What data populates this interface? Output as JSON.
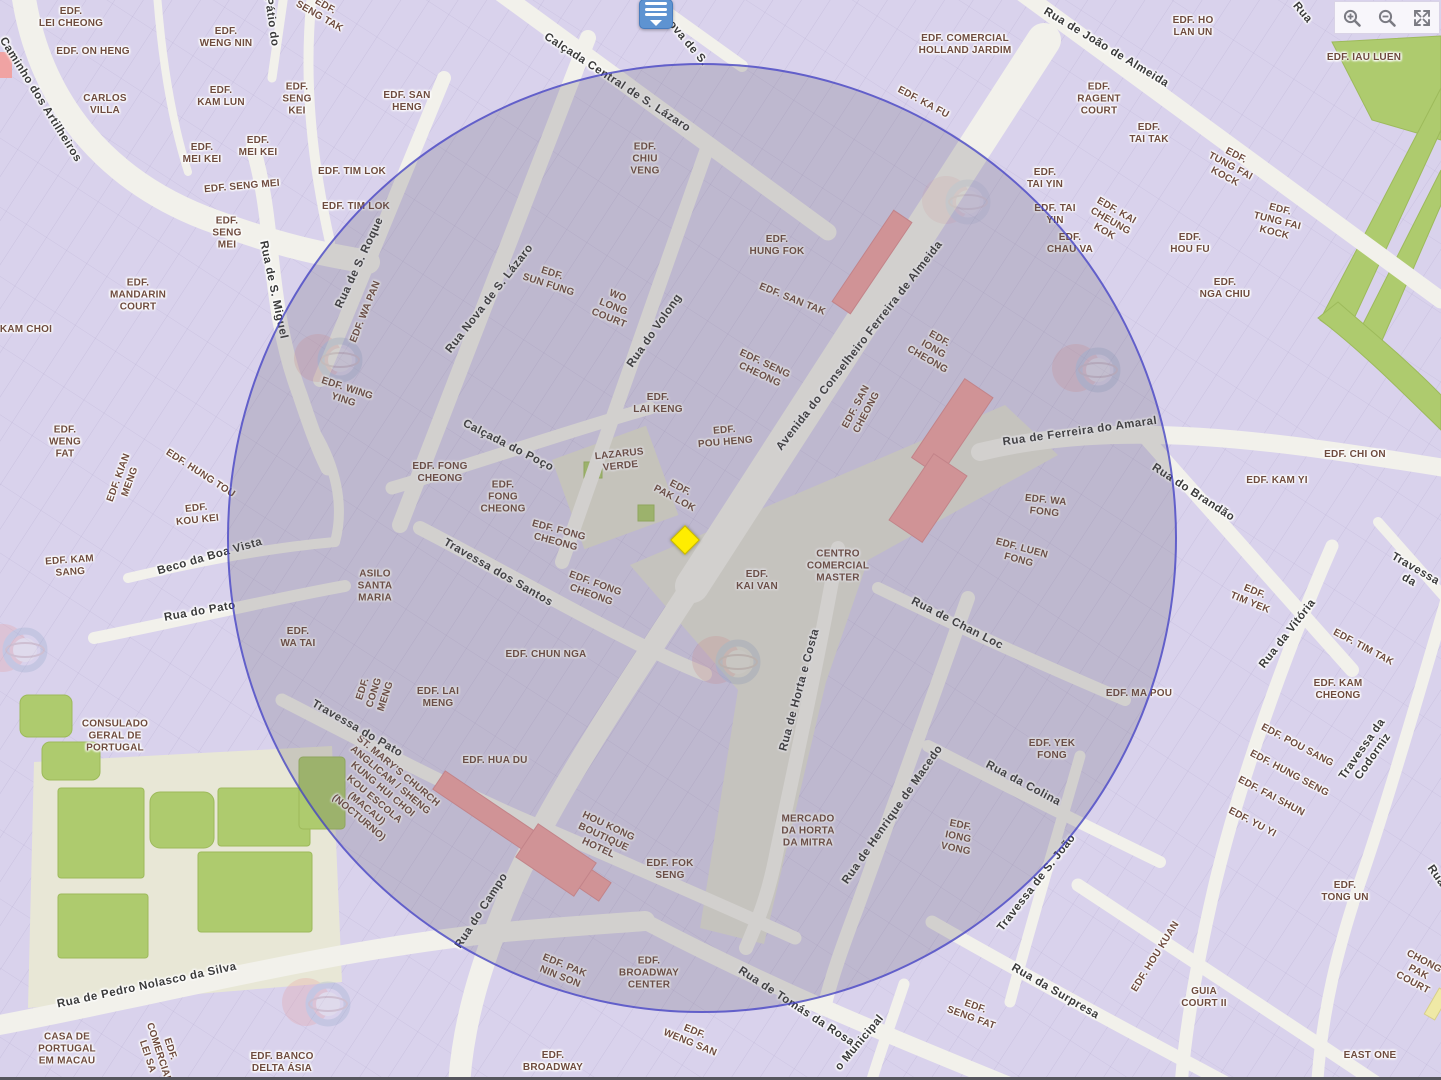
{
  "map": {
    "palette": {
      "building_fill": "#D9D2EC",
      "street_fill": "#F2F1EB",
      "green": "#AECB6E",
      "courtyard": "#E8E7D6",
      "highlight_red": "#F0A3A3",
      "highlight_yellow_building": "#EFE9A6",
      "circle_stroke": "#4342C8",
      "building_label": "#6E4B3E",
      "street_label": "#3A3A3A",
      "marker_yellow": "#FFED00",
      "marker_blue": "#5E93D1"
    },
    "controls": [
      {
        "id": "zoom-in"
      },
      {
        "id": "zoom-out"
      },
      {
        "id": "fullscreen"
      }
    ],
    "selection_circle": {
      "cx": 702,
      "cy": 538,
      "r": 475
    },
    "markers": {
      "selected_location": {
        "x": 685,
        "y": 540
      },
      "list_pin": {
        "x": 656,
        "y": 14
      }
    },
    "labels": [
      {
        "t": "EDF.\nLEI CHEONG",
        "x": 71,
        "y": 18,
        "r": 0,
        "k": "b"
      },
      {
        "t": "EDF. ON HENG",
        "x": 93,
        "y": 52,
        "r": 0,
        "k": "b"
      },
      {
        "t": "CARLOS\nVILLA",
        "x": 105,
        "y": 105,
        "r": 0,
        "k": "b"
      },
      {
        "t": "EDF.\nWENG NIN",
        "x": 226,
        "y": 38,
        "r": 0,
        "k": "b"
      },
      {
        "t": "EDF.\nKAM LUN",
        "x": 221,
        "y": 97,
        "r": 0,
        "k": "b"
      },
      {
        "t": "EDF.\nSENG\nKEI",
        "x": 297,
        "y": 100,
        "r": 0,
        "k": "b"
      },
      {
        "t": "EDF.\nMEI KEI",
        "x": 202,
        "y": 154,
        "r": 0,
        "k": "b"
      },
      {
        "t": "EDF.\nMEI KEI",
        "x": 258,
        "y": 147,
        "r": 0,
        "k": "b"
      },
      {
        "t": "EDF. SENG MEI",
        "x": 242,
        "y": 187,
        "r": -5,
        "k": "b"
      },
      {
        "t": "EDF.\nSENG\nMEI",
        "x": 227,
        "y": 234,
        "r": 0,
        "k": "b"
      },
      {
        "t": "EDF.\nSENG TAK",
        "x": 322,
        "y": 12,
        "r": 30,
        "k": "b"
      },
      {
        "t": "EDF. TIM LOK",
        "x": 352,
        "y": 172,
        "r": 0,
        "k": "b"
      },
      {
        "t": "EDF. TIM LOK",
        "x": 356,
        "y": 207,
        "r": 0,
        "k": "b"
      },
      {
        "t": "EDF. SAN\nHENG",
        "x": 407,
        "y": 102,
        "r": 0,
        "k": "b"
      },
      {
        "t": "EDF.\nMANDARIN\nCOURT",
        "x": 138,
        "y": 296,
        "r": 0,
        "k": "b"
      },
      {
        "t": "KAM CHOI",
        "x": 26,
        "y": 330,
        "r": 0,
        "k": "b"
      },
      {
        "t": "EDF.\nWENG\nFAT",
        "x": 65,
        "y": 443,
        "r": 0,
        "k": "b"
      },
      {
        "t": "EDF. KIAN\nMENG",
        "x": 125,
        "y": 480,
        "r": -70,
        "k": "b"
      },
      {
        "t": "EDF. HUNG TOU",
        "x": 200,
        "y": 474,
        "r": 33,
        "k": "b"
      },
      {
        "t": "EDF.\nKOU KEI",
        "x": 197,
        "y": 515,
        "r": -6,
        "k": "b"
      },
      {
        "t": "EDF. KAM\nSANG",
        "x": 70,
        "y": 567,
        "r": -4,
        "k": "b"
      },
      {
        "t": "EDF. WING\nYING",
        "x": 345,
        "y": 395,
        "r": 18,
        "k": "b"
      },
      {
        "t": "EDF. WA PAN",
        "x": 366,
        "y": 312,
        "r": -68,
        "k": "b"
      },
      {
        "t": "EDF.\nSUN FUNG",
        "x": 550,
        "y": 280,
        "r": 18,
        "k": "b"
      },
      {
        "t": "WO\nLONG\nCOURT",
        "x": 613,
        "y": 308,
        "r": 22,
        "k": "b"
      },
      {
        "t": "EDF.\nCHIU\nVENG",
        "x": 645,
        "y": 160,
        "r": 0,
        "k": "b"
      },
      {
        "t": "EDF.\nHUNG FOK",
        "x": 777,
        "y": 246,
        "r": 0,
        "k": "b"
      },
      {
        "t": "EDF. SAN TAK",
        "x": 792,
        "y": 300,
        "r": 22,
        "k": "b"
      },
      {
        "t": "EDF. SENG\nCHEONG",
        "x": 762,
        "y": 370,
        "r": 25,
        "k": "b"
      },
      {
        "t": "EDF.\nLAI KENG",
        "x": 658,
        "y": 404,
        "r": 0,
        "k": "b"
      },
      {
        "t": "EDF.\nPOU HENG",
        "x": 725,
        "y": 437,
        "r": -5,
        "k": "b"
      },
      {
        "t": "LAZARUS\nVERDE",
        "x": 620,
        "y": 461,
        "r": -6,
        "k": "b"
      },
      {
        "t": "EDF.\nPAK LOK",
        "x": 677,
        "y": 494,
        "r": 28,
        "k": "b"
      },
      {
        "t": "EDF. FONG\nCHEONG",
        "x": 440,
        "y": 473,
        "r": 0,
        "k": "b"
      },
      {
        "t": "EDF.\nFONG\nCHEONG",
        "x": 503,
        "y": 498,
        "r": 0,
        "k": "b"
      },
      {
        "t": "EDF. FONG\nCHEONG",
        "x": 557,
        "y": 537,
        "r": 15,
        "k": "b"
      },
      {
        "t": "EDF. FONG\nCHEONG",
        "x": 593,
        "y": 590,
        "r": 20,
        "k": "b"
      },
      {
        "t": "EDF.\nIONG\nCHEONG",
        "x": 933,
        "y": 350,
        "r": 30,
        "k": "b"
      },
      {
        "t": "EDF. SAN\nCHEONG",
        "x": 862,
        "y": 410,
        "r": -62,
        "k": "b"
      },
      {
        "t": "CENTRO\nCOMERCIAL\nMASTER",
        "x": 838,
        "y": 567,
        "r": 0,
        "k": "b"
      },
      {
        "t": "EDF.\nKAI VAN",
        "x": 757,
        "y": 581,
        "r": 0,
        "k": "b"
      },
      {
        "t": "EDF. WA\nFONG",
        "x": 1045,
        "y": 507,
        "r": 6,
        "k": "b"
      },
      {
        "t": "EDF. LUEN\nFONG",
        "x": 1020,
        "y": 555,
        "r": 15,
        "k": "b"
      },
      {
        "t": "ASILO\nSANTA\nMARIA",
        "x": 375,
        "y": 587,
        "r": 0,
        "k": "b"
      },
      {
        "t": "EDF.\nWA TAI",
        "x": 298,
        "y": 638,
        "r": 0,
        "k": "b"
      },
      {
        "t": "EDF.\nCONG\nMENG",
        "x": 375,
        "y": 693,
        "r": -72,
        "k": "b"
      },
      {
        "t": "EDF. LAI\nMENG",
        "x": 438,
        "y": 698,
        "r": 0,
        "k": "b"
      },
      {
        "t": "EDF. CHUN NGA",
        "x": 546,
        "y": 655,
        "r": 0,
        "k": "b"
      },
      {
        "t": "EDF. HUA DU",
        "x": 495,
        "y": 761,
        "r": 0,
        "k": "b"
      },
      {
        "t": "ST. MARY'S CHURCH\nANGLICAM / SHENG\nKUNG HUI CHOI\nKOU ESCOLA\n(MACAU)\n(NOCTURNO)",
        "x": 378,
        "y": 795,
        "r": 40,
        "k": "b"
      },
      {
        "t": "HOU KONG\nBOUTIQUE\nHOTEL",
        "x": 603,
        "y": 838,
        "r": 25,
        "k": "b"
      },
      {
        "t": "EDF. FOK\nSENG",
        "x": 670,
        "y": 870,
        "r": 0,
        "k": "b"
      },
      {
        "t": "EDF. PAK\nNIN SON",
        "x": 562,
        "y": 972,
        "r": 22,
        "k": "b"
      },
      {
        "t": "EDF.\nBROADWAY\nCENTER",
        "x": 649,
        "y": 974,
        "r": 0,
        "k": "b"
      },
      {
        "t": "EDF.\nWENG SAN",
        "x": 692,
        "y": 1038,
        "r": 22,
        "k": "b"
      },
      {
        "t": "EDF.\nBROADWAY",
        "x": 553,
        "y": 1062,
        "r": 0,
        "k": "b"
      },
      {
        "t": "MERCADO\nDA HORTA\nDA MITRA",
        "x": 808,
        "y": 832,
        "r": 0,
        "k": "b"
      },
      {
        "t": "EDF.\nIONG\nVONG",
        "x": 958,
        "y": 838,
        "r": 12,
        "k": "b"
      },
      {
        "t": "EDF.\nSENG FAT",
        "x": 973,
        "y": 1013,
        "r": 20,
        "k": "b"
      },
      {
        "t": "EDF. YEK\nFONG",
        "x": 1052,
        "y": 750,
        "r": 0,
        "k": "b"
      },
      {
        "t": "EDF. MA POU",
        "x": 1139,
        "y": 694,
        "r": 0,
        "k": "b"
      },
      {
        "t": "EDF. COMERCIAL\nHOLLAND JARDIM",
        "x": 965,
        "y": 45,
        "r": 0,
        "k": "b"
      },
      {
        "t": "EDF. KA FU",
        "x": 923,
        "y": 103,
        "r": 28,
        "k": "b"
      },
      {
        "t": "EDF.\nRAGENT\nCOURT",
        "x": 1099,
        "y": 100,
        "r": 0,
        "k": "b"
      },
      {
        "t": "EDF.\nTAI TAK",
        "x": 1149,
        "y": 134,
        "r": 0,
        "k": "b"
      },
      {
        "t": "EDF.\nTAI YIN",
        "x": 1045,
        "y": 179,
        "r": 0,
        "k": "b"
      },
      {
        "t": "EDF. TAI\nYIN",
        "x": 1055,
        "y": 215,
        "r": 0,
        "k": "b"
      },
      {
        "t": "EDF.\nCHAU VA",
        "x": 1070,
        "y": 244,
        "r": 0,
        "k": "b"
      },
      {
        "t": "EDF. KAI\nCHEUNG\nKOK",
        "x": 1110,
        "y": 222,
        "r": 30,
        "k": "b"
      },
      {
        "t": "EDF. HO\nLAN UN",
        "x": 1193,
        "y": 27,
        "r": 0,
        "k": "b"
      },
      {
        "t": "EDF. IAU LUEN",
        "x": 1364,
        "y": 58,
        "r": 0,
        "k": "b"
      },
      {
        "t": "EDF.\nTUNG FAI\nKOCK",
        "x": 1230,
        "y": 167,
        "r": 28,
        "k": "b"
      },
      {
        "t": "EDF.\nTUNG FAI\nKOCK",
        "x": 1277,
        "y": 222,
        "r": 14,
        "k": "b"
      },
      {
        "t": "EDF.\nHOU FU",
        "x": 1190,
        "y": 244,
        "r": 0,
        "k": "b"
      },
      {
        "t": "EDF.\nNGA CHIU",
        "x": 1225,
        "y": 289,
        "r": 0,
        "k": "b"
      },
      {
        "t": "EDF. CHI ON",
        "x": 1355,
        "y": 455,
        "r": 0,
        "k": "b"
      },
      {
        "t": "EDF. KAM YI",
        "x": 1277,
        "y": 481,
        "r": 0,
        "k": "b"
      },
      {
        "t": "EDF.\nTIM YEK",
        "x": 1252,
        "y": 598,
        "r": 22,
        "k": "b"
      },
      {
        "t": "EDF. TIM TAK",
        "x": 1363,
        "y": 648,
        "r": 28,
        "k": "b"
      },
      {
        "t": "EDF. KAM\nCHEONG",
        "x": 1338,
        "y": 690,
        "r": 0,
        "k": "b"
      },
      {
        "t": "EDF. POU SANG",
        "x": 1297,
        "y": 746,
        "r": 28,
        "k": "b"
      },
      {
        "t": "EDF. HUNG SENG",
        "x": 1289,
        "y": 774,
        "r": 28,
        "k": "b"
      },
      {
        "t": "EDF. FAI SHUN",
        "x": 1271,
        "y": 797,
        "r": 28,
        "k": "b"
      },
      {
        "t": "EDF. YU YI",
        "x": 1252,
        "y": 823,
        "r": 28,
        "k": "b"
      },
      {
        "t": "EDF.\nTONG UN",
        "x": 1345,
        "y": 892,
        "r": 0,
        "k": "b"
      },
      {
        "t": "EDF. HOU KUAN",
        "x": 1156,
        "y": 957,
        "r": -58,
        "k": "b"
      },
      {
        "t": "GUIA\nCOURT II",
        "x": 1204,
        "y": 998,
        "r": 0,
        "k": "b"
      },
      {
        "t": "EAST ONE",
        "x": 1370,
        "y": 1056,
        "r": 0,
        "k": "b"
      },
      {
        "t": "CHONG\nPAK\nCOURT",
        "x": 1418,
        "y": 973,
        "r": 28,
        "k": "b"
      },
      {
        "t": "CASA DE\nPORTUGAL\nEM MACAU",
        "x": 67,
        "y": 1050,
        "r": 0,
        "k": "b"
      },
      {
        "t": "EDF.\nCOMERCIAL\nLEI SA",
        "x": 158,
        "y": 1053,
        "r": 72,
        "k": "b"
      },
      {
        "t": "EDF. BANCO\nDELTA ÁSIA",
        "x": 282,
        "y": 1063,
        "r": 0,
        "k": "b"
      },
      {
        "t": "CONSULADO\nGERAL DE\nPORTUGAL",
        "x": 115,
        "y": 737,
        "r": 0,
        "k": "b"
      },
      {
        "t": "Caminho dos Artilheiros",
        "x": 40,
        "y": 100,
        "r": 58,
        "k": "s"
      },
      {
        "t": "Pátio do",
        "x": 271,
        "y": 22,
        "r": 82,
        "k": "s"
      },
      {
        "t": "Rua de S. Miguel",
        "x": 273,
        "y": 290,
        "r": 78,
        "k": "s"
      },
      {
        "t": "Rua de S. Roque",
        "x": 360,
        "y": 263,
        "r": -65,
        "k": "s"
      },
      {
        "t": "Rua Nova de S. Lázaro",
        "x": 490,
        "y": 299,
        "r": -52,
        "k": "s"
      },
      {
        "t": "Rua Nova de S.",
        "x": 676,
        "y": 30,
        "r": 50,
        "k": "s"
      },
      {
        "t": "Calçada Central de S. Lázaro",
        "x": 617,
        "y": 83,
        "r": 33,
        "k": "s"
      },
      {
        "t": "Rua do Volong",
        "x": 655,
        "y": 331,
        "r": -55,
        "k": "s"
      },
      {
        "t": "Avenida do Conselheiro Ferreira de Almeida",
        "x": 860,
        "y": 346,
        "r": -52,
        "k": "s"
      },
      {
        "t": "Rua de João de Almeida",
        "x": 1106,
        "y": 48,
        "r": 31,
        "k": "s"
      },
      {
        "t": "Rua de Ferreira do Amaral",
        "x": 1080,
        "y": 432,
        "r": -8,
        "k": "s"
      },
      {
        "t": "Rua do Brandão",
        "x": 1193,
        "y": 493,
        "r": 33,
        "k": "s"
      },
      {
        "t": "Travessa da",
        "x": 1412,
        "y": 575,
        "r": 30,
        "k": "s"
      },
      {
        "t": "Rua da Vitória",
        "x": 1288,
        "y": 634,
        "r": -52,
        "k": "s"
      },
      {
        "t": "Travessa da Codorniz",
        "x": 1368,
        "y": 753,
        "r": -55,
        "k": "s"
      },
      {
        "t": "Calçada do Poço",
        "x": 508,
        "y": 446,
        "r": 27,
        "k": "s"
      },
      {
        "t": "Travessa dos Santos",
        "x": 498,
        "y": 573,
        "r": 30,
        "k": "s"
      },
      {
        "t": "Beco da Boa Vista",
        "x": 210,
        "y": 557,
        "r": -16,
        "k": "s"
      },
      {
        "t": "Rua do Pato",
        "x": 200,
        "y": 612,
        "r": -10,
        "k": "s"
      },
      {
        "t": "Travessa do Pato",
        "x": 357,
        "y": 729,
        "r": 30,
        "k": "s"
      },
      {
        "t": "Rua do Campo",
        "x": 482,
        "y": 911,
        "r": -57,
        "k": "s"
      },
      {
        "t": "Rua de Horta e Costa",
        "x": 800,
        "y": 690,
        "r": -75,
        "k": "s"
      },
      {
        "t": "Rua de Henrique de Macedo",
        "x": 893,
        "y": 815,
        "r": -55,
        "k": "s"
      },
      {
        "t": "Rua de Chan Loc",
        "x": 957,
        "y": 624,
        "r": 27,
        "k": "s"
      },
      {
        "t": "Rua da Colina",
        "x": 1023,
        "y": 784,
        "r": 28,
        "k": "s"
      },
      {
        "t": "Travessa de S. João",
        "x": 1037,
        "y": 883,
        "r": -52,
        "k": "s"
      },
      {
        "t": "Rua da Surpresa",
        "x": 1055,
        "y": 992,
        "r": 30,
        "k": "s"
      },
      {
        "t": "Rua de Tomás da Rosa",
        "x": 796,
        "y": 1007,
        "r": 33,
        "k": "s"
      },
      {
        "t": "o Municipal",
        "x": 860,
        "y": 1043,
        "r": -50,
        "k": "s"
      },
      {
        "t": "Rua de Pedro Nolasco da Silva",
        "x": 147,
        "y": 986,
        "r": -12,
        "k": "s"
      },
      {
        "t": "Rua",
        "x": 1302,
        "y": 13,
        "r": 50,
        "k": "s"
      },
      {
        "t": "Rua",
        "x": 1436,
        "y": 876,
        "r": 55,
        "k": "s"
      }
    ]
  }
}
